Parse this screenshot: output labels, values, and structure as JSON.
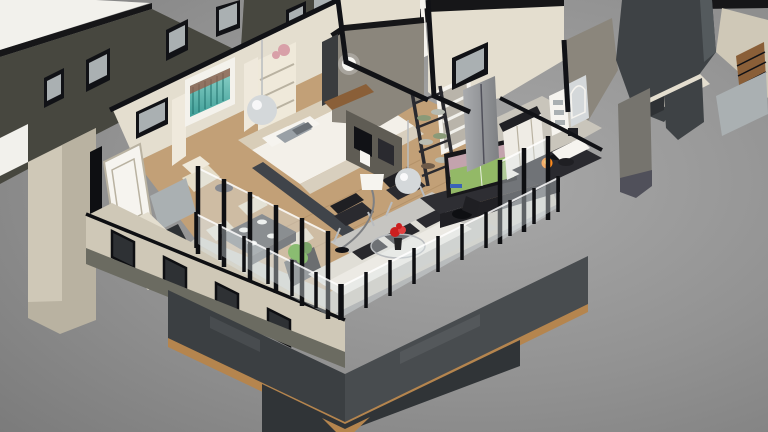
{
  "scene": {
    "type": "3d-isometric-floorplan-cutaway-render",
    "background": "gray gradient studio backdrop",
    "rooms": [
      {
        "name": "bedroom",
        "objects": [
          "tufted-bed",
          "white-pillows",
          "gray-accent-pillows",
          "teal-abstract-artwork",
          "glass-sphere-pendant",
          "wall-shelf-with-flowers",
          "window",
          "white-door",
          "cream-armchair",
          "mirrored-dresser",
          "cut-roof-beam"
        ]
      },
      {
        "name": "dining-area",
        "objects": [
          "dark-dining-table",
          "four-white-plates",
          "cream-chairs",
          "green-planter-box"
        ]
      },
      {
        "name": "living-room",
        "objects": [
          "white-sofa",
          "patterned-cushions",
          "two-black-leather-armchairs",
          "glass-coffee-table",
          "red-flowers",
          "arc-floor-lamp",
          "mirror-ball-pendant",
          "ladder-shelf-with-dishes",
          "tv-showing-soccer",
          "media-console",
          "office-chair",
          "gray-rug",
          "wood-plank-floor"
        ]
      },
      {
        "name": "kitchen",
        "objects": [
          "stainless-fridge",
          "white-cabinets",
          "black-countertop",
          "island-with-gas-flame",
          "towel-shelf",
          "arch-mirror",
          "window"
        ]
      },
      {
        "name": "hallway",
        "objects": [
          "white-stair-frame",
          "taupe-feature-wall",
          "wall-sconce",
          "white-vanity-desk"
        ]
      },
      {
        "name": "balcony",
        "objects": [
          "glass-railing",
          "black-posts",
          "charcoal-base-band",
          "wood-trim",
          "stone-piers"
        ]
      }
    ],
    "adjacent_structures": [
      "flat-white-roof-slabs",
      "olive-wall-with-windows",
      "stone-corner-columns",
      "charcoal-corner-tower",
      "gray-pillars",
      "wood-slat-accent"
    ]
  },
  "palette": {
    "bgLight": "#a9a9a9",
    "bgMid": "#929292",
    "bgDark": "#7b7b7b",
    "slabWhite": "#f2f1ec",
    "slabShade": "#dddcd6",
    "fasciaBlack": "#161618",
    "blackTrim": "#111216",
    "wallOlive": "#47473f",
    "oliveBand": "#6b6b61",
    "glassGray": "#aab0b2",
    "glassDark": "#868e91",
    "paneDark": "#2e3134",
    "stoneCream": "#cfc8b7",
    "stoneShade": "#b9b2a1",
    "wallCream": "#e4decf",
    "wallCreamLight": "#efe9da",
    "tealMain": "#3f9e97",
    "tealLight": "#8fd4cb",
    "tealDark": "#20706c",
    "artRust": "#9a5a46",
    "artWhite": "#f4f2ec",
    "bedWhite": "#f3f0e9",
    "bedCream": "#d8cdb8",
    "benchCream": "#d8cfbe",
    "pillowGray": "#99a0a6",
    "pillowDark": "#6a7076",
    "woodFloor": "#c2a077",
    "woodLine": "#a8865c",
    "woodTrim": "#b5854e",
    "woodDark": "#8a5f38",
    "rug": "#c6c5c1",
    "sofaWhite": "#eceae4",
    "sofaSeat": "#e0ded6",
    "cushionDark": "#28282c",
    "chairBlack": "#1f1f23",
    "chairBlack2": "#2a2a2f",
    "chrome": "#b9bcbf",
    "glassTint": "rgba(226,233,236,0.38)",
    "glassStroke": "rgba(255,255,255,0.85)",
    "postBlack": "#0e0f12",
    "charcoalBase": "#3b3f42",
    "charcoalBaseLight": "#484c4f",
    "charcoalLower": "#303437",
    "tableDark": "#55565a",
    "tableEdge": "#3c3d41",
    "plateWhite": "#f5f5f1",
    "chairCream": "#e5ddc8",
    "plantGreen": "#55a026",
    "plantDark": "#3d7a1c",
    "planter": "#232325",
    "flameOrange": "#ff8c1e",
    "flameYellow": "#ffd050",
    "tvBezel": "#17171a",
    "tvField": "#93b967",
    "tvCrowd": "#c3a3ad",
    "tvScore": "#3b62b8",
    "steel": "#a9abae",
    "steelDark": "#7e8083",
    "counterBlack": "#202024",
    "cabinetWhite": "#efece5",
    "towerCharcoal": "#3e4245",
    "towerLight": "#545a5d",
    "colGray": "#76746e",
    "colCap": "#50505a",
    "tileGray": "#c9c5bb",
    "taupeWall": "#8b867c",
    "mirrorDark": "#3a3c3e",
    "divider": "#5f5c54",
    "white": "#f6f4ef",
    "beamDark": "#40444a",
    "consoleDark": "#2e2e33",
    "sage": "#8a9a78",
    "dishGray": "#b8bcb2",
    "dishBrown": "#6d5a48",
    "flowerRed": "#cc1f1f",
    "flowerRed2": "#e24040",
    "flowerPink": "#d8a0a8",
    "curtain": "#efe9dc",
    "sphereGlass": "#d4d8da",
    "stairGray": "#b9b4aa"
  }
}
